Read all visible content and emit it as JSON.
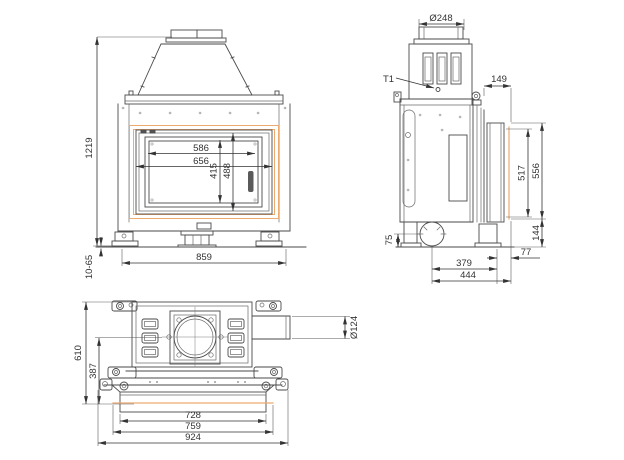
{
  "drawing_title": "fireplace-insert-dimension-drawing",
  "colors": {
    "accent_text": "#d9823c",
    "accent_line": "#eeab70",
    "line": "#4a4a4a",
    "dim_line": "#333333"
  },
  "dims": {
    "front": {
      "overall_height": "1219",
      "glass_width": "586",
      "door_width": "656",
      "glass_height": "415",
      "door_height": "488",
      "base_width": "859",
      "foot_adjust": "10-65"
    },
    "side": {
      "flue_diameter": "Ø248",
      "thermo_label": "T1",
      "top_depth": "149",
      "door_front_height": "517",
      "frame_front_height": "556",
      "floor_clearance": "144",
      "inlet_center_height": "75",
      "frame_overhang": "77",
      "inlet_to_front": "379",
      "overall_depth_front": "444"
    },
    "bottom": {
      "overall_depth": "610",
      "flue_center_to_front": "387",
      "inlet_diameter": "Ø124",
      "panel_width": "728",
      "frame_width": "759",
      "overall_width": "924"
    }
  }
}
